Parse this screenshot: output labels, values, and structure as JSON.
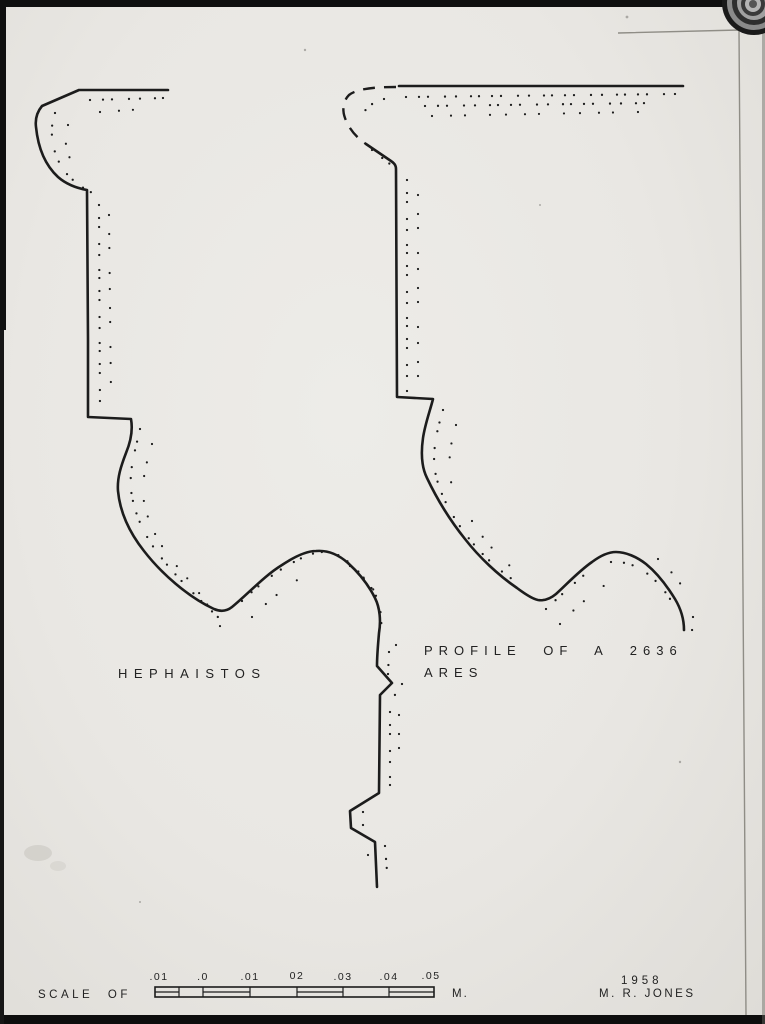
{
  "figure": {
    "ink": "#1c1c1c",
    "paper": "#e9e7e3",
    "hephaistos": {
      "label": "HEPHAISTOS",
      "outline": "M 168,90 L 79,90 L 42,106 C 37,112 35,119 36,127 C 38,147 45,165 58,177 C 66,184 76,188 87,190 L 88,340 L 88,417 L 131,419 C 133,430 131,441 126,453 C 121,466 117,478 118,491 C 120,512 129,532 144,551 C 161,573 188,597 214,609 C 221,612 227,611 232,607 C 249,593 264,576 282,565 C 294,557 306,551 316,551 C 328,550 339,555 348,563 C 359,573 369,586 375,598 C 380,608 381,621 379,633 C 378,645 377,655 377,666 L 392,683 L 380,695 L 379,793 L 350,811 L 351,828 L 375,842 L 377,887",
      "stipple1": "M 90,100 L 163,98 M 55,113 C 48,132 53,157 66,173 C 75,183 86,191 98,195 M 99,205 L 100,412 M 140,429 C 136,448 129,468 131,490 C 134,514 145,537 160,556 C 177,578 199,599 221,620 M 242,601 C 258,586 277,570 296,561 C 310,553 326,548 340,556 C 353,564 365,578 374,592 C 381,604 382,620 381,634 M 389,652 L 388,674 M 402,684 L 391,701 M 390,712 L 390,789 M 363,812 L 363,830 M 385,846 L 388,884",
      "stipple2": "M 100,112 L 145,109 M 68,125 C 62,142 68,160 79,172 M 109,215 L 111,395 M 152,444 C 146,464 141,482 144,502 C 148,523 158,542 171,559 C 186,578 205,595 224,634 M 252,617 C 269,600 289,584 309,573 M 350,566 C 361,575 371,586 380,598 M 396,645 L 395,662 M 399,715 L 399,760 M 368,855 L 371,872"
    },
    "ares": {
      "label_line1": "PROFILE OF A 2636",
      "label_line2": "ARES",
      "top_edge": "M 683,86 L 399,86",
      "dashed_edge": "M 396,87 C 378,87 358,88 349,95 C 343,101 342,110 345,118 C 349,129 356,137 366,144",
      "outline": "M 366,144 L 391,161 C 394,163 396,165 396,169 L 397,397 L 433,399 C 430,411 425,424 423,438 C 421,452 421,466 427,478 C 436,497 449,519 465,539 C 479,557 498,575 517,588 C 525,594 533,599 538,600 C 544,601 550,599 556,594 C 567,584 579,571 592,562 C 600,556 608,552 616,552 C 626,552 637,557 646,564 C 657,573 667,586 675,599 C 681,609 684,620 684,630",
      "stipple1": "M 406,97 L 676,94 M 425,106 L 655,103 M 384,99 C 371,102 362,111 360,122 M 372,150 L 395,168 M 407,180 L 407,392 M 443,410 C 437,430 432,451 435,471 C 439,493 451,515 467,536 C 481,554 499,571 518,583 M 546,609 C 559,597 573,584 589,571 M 611,562 C 625,561 638,566 649,575 C 660,584 669,596 676,609 M 693,617 L 692,631",
      "stipple2": "M 432,116 L 638,112 M 418,195 L 418,378 M 456,425 C 449,448 447,469 453,490 M 472,521 C 484,541 500,558 516,571 M 560,624 C 574,609 589,596 605,585 M 658,559 C 670,569 680,582 689,597"
    }
  },
  "scale_bar": {
    "prefix": "SCALE OF",
    "unit": "M.",
    "ticks": [
      ".01",
      ".0",
      ".01",
      "02",
      ".03",
      ".04",
      ".05"
    ]
  },
  "credits": {
    "year": "1958",
    "author": "M. R. JONES"
  }
}
